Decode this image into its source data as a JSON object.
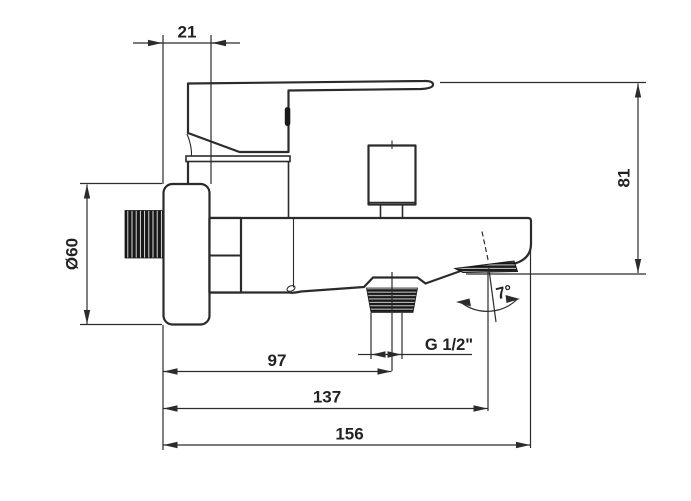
{
  "drawing": {
    "background": "#ffffff",
    "line_color": "#2b2b2b",
    "hatch_color": "#191919",
    "dimensions": {
      "flange_depth": "21",
      "flange_diameter": "Ø60",
      "total_height": "81",
      "shower_outlet_offset": "97",
      "spout_outlet_offset": "137",
      "total_length": "156",
      "outlet_thread": "G 1/2\"",
      "spout_angle": "7°"
    }
  }
}
